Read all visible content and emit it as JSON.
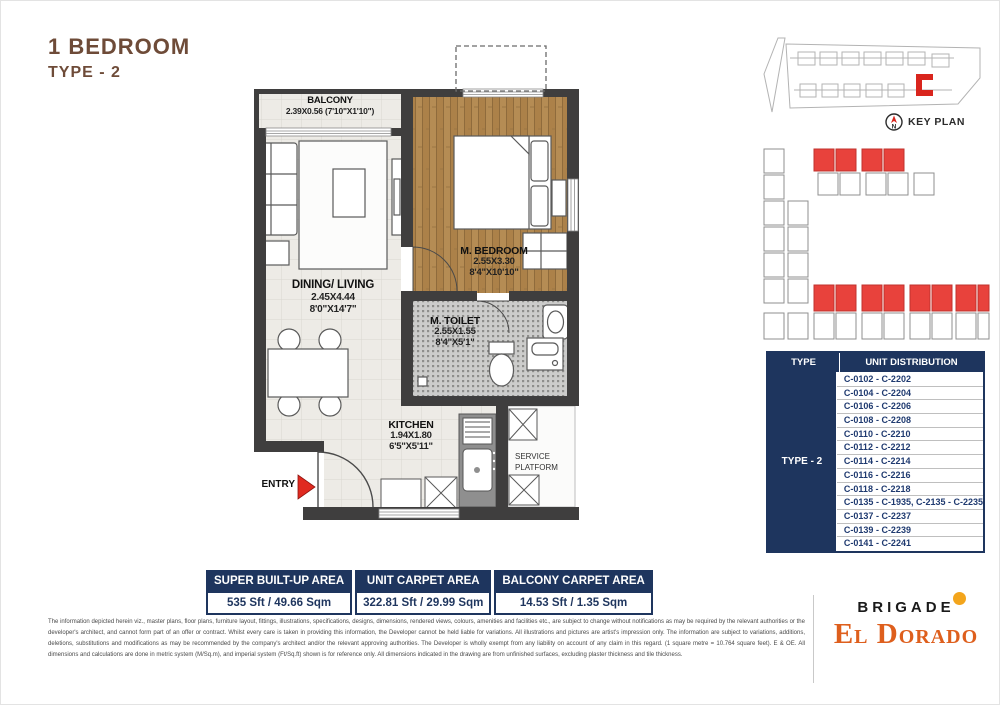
{
  "header": {
    "title": "1 BEDROOM",
    "subtitle": "TYPE - 2"
  },
  "floorplan": {
    "entry_label": "ENTRY",
    "rooms": {
      "balcony": {
        "name": "BALCONY",
        "dims": "2.39X0.56 (7'10\"X1'10\")"
      },
      "dining": {
        "name": "DINING/ LIVING",
        "dim_m": "2.45X4.44",
        "dim_ft": "8'0\"X14'7\""
      },
      "bedroom": {
        "name": "M. BEDROOM",
        "dim_m": "2.55X3.30",
        "dim_ft": "8'4\"X10'10\""
      },
      "toilet": {
        "name": "M. TOILET",
        "dim_m": "2.55X1.55",
        "dim_ft": "8'4\"X5'1\""
      },
      "kitchen": {
        "name": "KITCHEN",
        "dim_m": "1.94X1.80",
        "dim_ft": "6'5\"X5'11\""
      },
      "service": {
        "line1": "SERVICE",
        "line2": "PLATFORM"
      }
    }
  },
  "keyplan": {
    "caption": "KEY PLAN",
    "north": "N"
  },
  "unit_table": {
    "col_type": "TYPE",
    "col_dist": "UNIT DISTRIBUTION",
    "type_value": "TYPE - 2",
    "rows": [
      "C-0102 - C-2202",
      "C-0104 - C-2204",
      "C-0106 - C-2206",
      "C-0108 - C-2208",
      "C-0110 - C-2210",
      "C-0112 - C-2212",
      "C-0114 - C-2214",
      "C-0116 - C-2216",
      "C-0118 - C-2218",
      "C-0135 - C-1935, C-2135 - C-2235",
      "C-0137 - C-2237",
      "C-0139 - C-2239",
      "C-0141 - C-2241"
    ]
  },
  "areas": [
    {
      "label": "SUPER BUILT-UP AREA",
      "value": "535 Sft / 49.66 Sqm"
    },
    {
      "label": "UNIT CARPET AREA",
      "value": "322.81 Sft / 29.99 Sqm"
    },
    {
      "label": "BALCONY CARPET AREA",
      "value": "14.53 Sft / 1.35 Sqm"
    }
  ],
  "disclaimer": "The information depicted herein viz., master plans, floor plans, furniture layout, fittings, illustrations, specifications, designs, dimensions, rendered views, colours, amenities and facilities etc., are subject to change without notifications as may be required by the relevant authorities or the developer's architect, and cannot form part of an offer or contract. Whilst every care is taken in providing this information, the Developer cannot be held liable for variations. All illustrations and pictures are artist's impression only. The information are subject to variations, additions, deletions, substitutions and modifications as may be recommended by the company's architect and/or the relevant approving authorities. The Developer is wholly exempt from any liability on account of any claim in this regard. (1 square metre = 10.764 square feet). E & OE. All dimensions and calculations are done in metric system (M/Sq.m), and imperial system (Ft/Sq.ft) shown is for reference only. All dimensions indicated in the drawing are from unfinished surfaces, excluding plaster thickness and tile thickness.",
  "logo": {
    "brand": "BRIGADE",
    "project": "El Dorado"
  },
  "colors": {
    "navy": "#1e355e",
    "brown": "#6e4b38",
    "red": "#e23b30",
    "wood": "#b58c54",
    "yellow": "#f3a51c"
  }
}
